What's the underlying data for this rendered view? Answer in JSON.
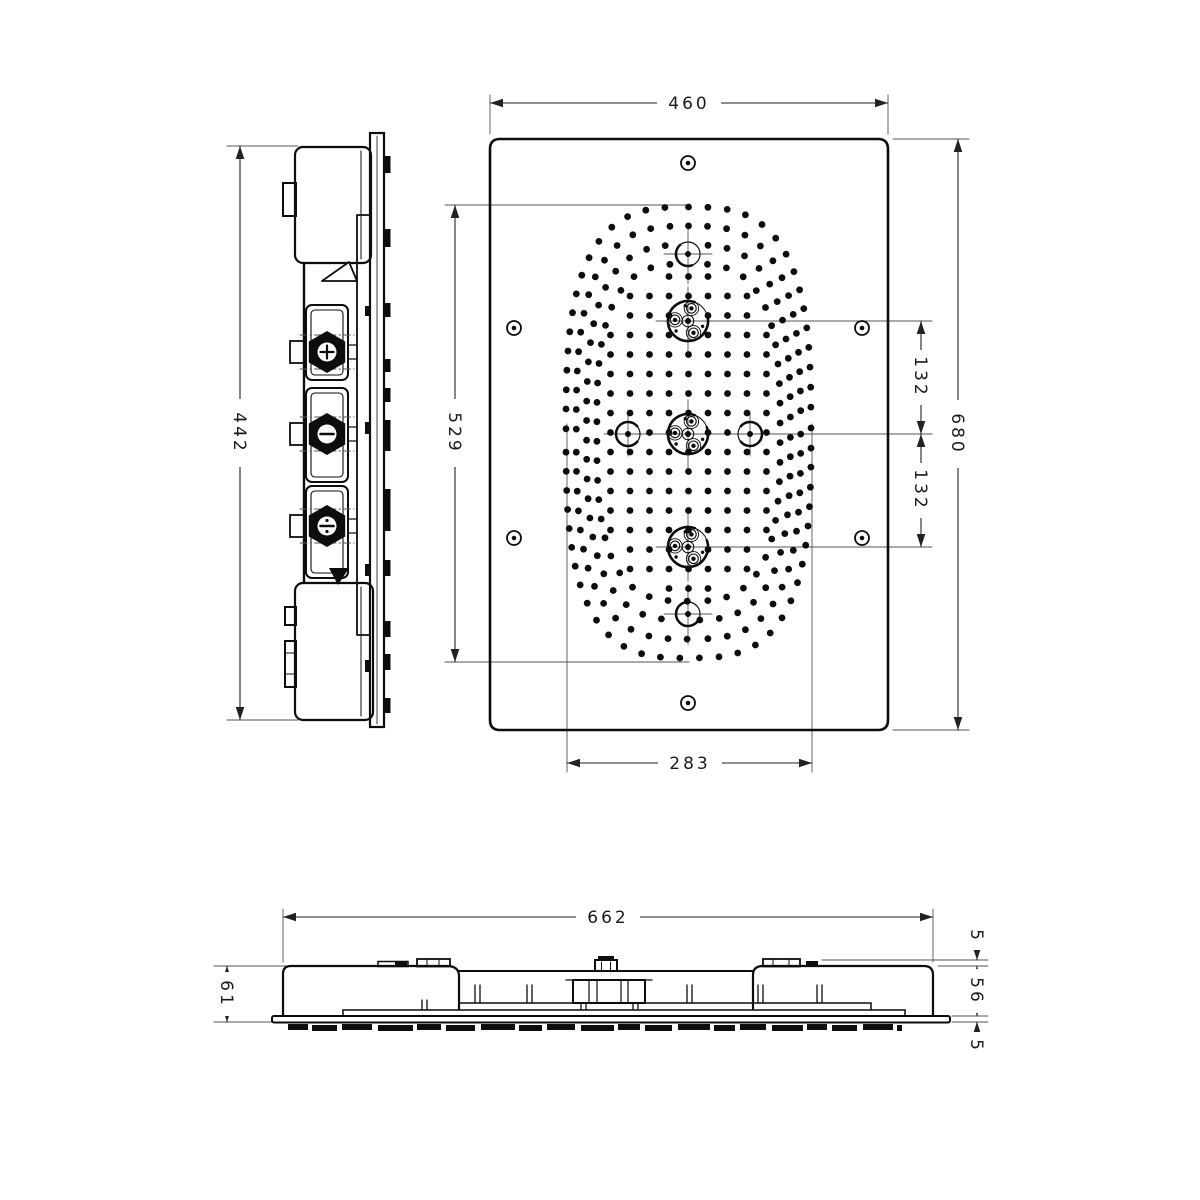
{
  "colors": {
    "ink": "#0d0d0d",
    "paper": "#ffffff",
    "dim_line": "#222222",
    "center_line": "#555555"
  },
  "views": {
    "side": {
      "dims": {
        "housing_height": "442"
      }
    },
    "front": {
      "dims": {
        "width": "460",
        "height": "680",
        "spray_field_height": "529",
        "spray_field_width": "283",
        "upper_jet_offset": "132",
        "lower_jet_offset": "132"
      },
      "screw_count": 6,
      "jet_module_count": 3
    },
    "bottom": {
      "dims": {
        "width": "662",
        "total_depth": "61",
        "clip_height": "5",
        "body_depth": "56",
        "panel_thickness": "5"
      }
    }
  }
}
